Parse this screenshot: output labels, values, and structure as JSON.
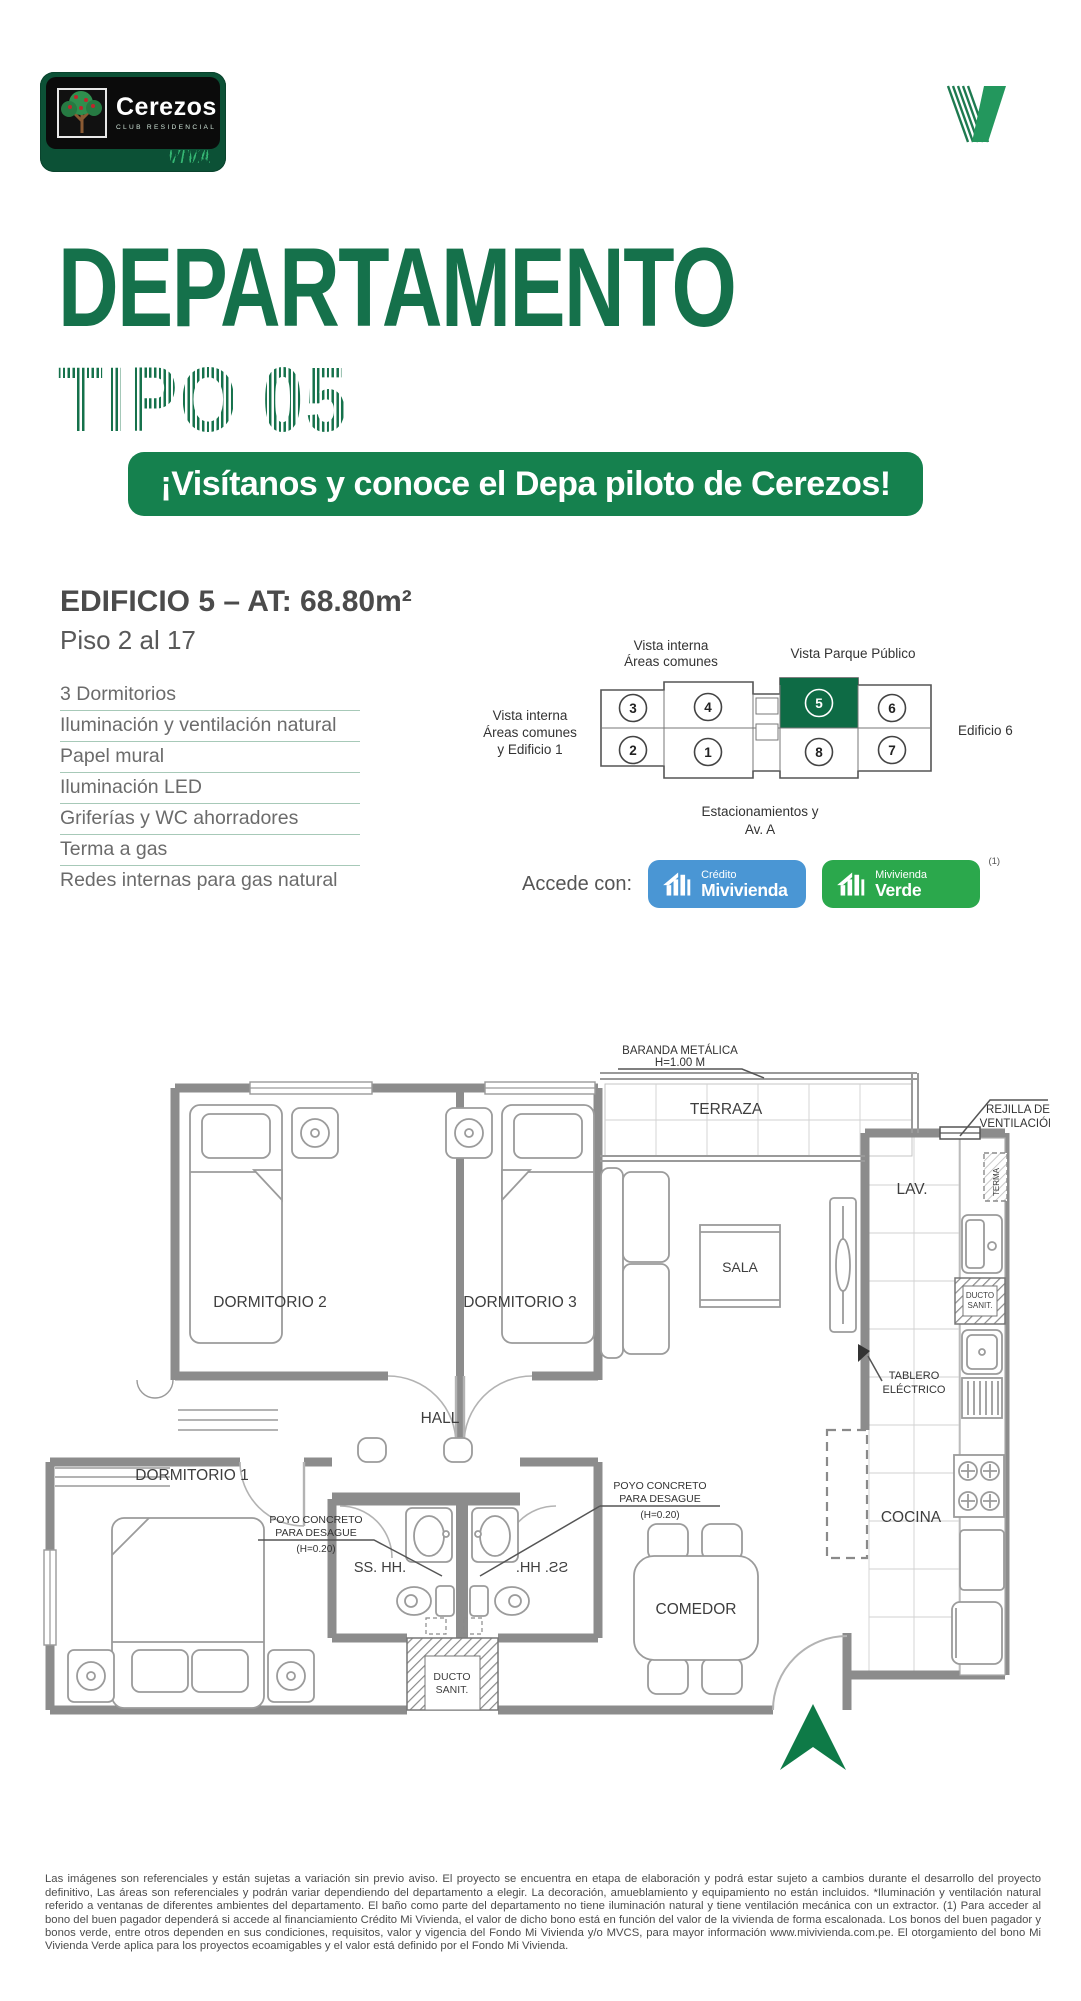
{
  "brand": {
    "name": "Cerezos",
    "tagline": "CLUB RESIDENCIAL",
    "viva": "VIVA"
  },
  "title": {
    "line1": "DEPARTAMENTO",
    "line2": "TIPO 05"
  },
  "banner": {
    "text": "¡Visítanos y conoce el Depa piloto de Cerezos!"
  },
  "building": {
    "heading": "EDIFICIO 5 – AT: 68.80m²",
    "floors": "Piso 2 al 17",
    "features": [
      "3 Dormitorios",
      "Iluminación y ventilación natural",
      "Papel mural",
      "Iluminación LED",
      "Griferías y WC ahorradores",
      "Terma a gas",
      "Redes internas para gas natural"
    ]
  },
  "keyplan": {
    "label_top_left_1": "Vista interna",
    "label_top_left_2": "Áreas comunes",
    "label_top_right": "Vista Parque Público",
    "label_left_1": "Vista interna",
    "label_left_2": "Áreas comunes",
    "label_left_3": "y Edificio 1",
    "label_right": "Edificio 6",
    "label_bottom_1": "Estacionamientos y",
    "label_bottom_2": "Av. A",
    "units": {
      "u1": "1",
      "u2": "2",
      "u3": "3",
      "u4": "4",
      "u5": "5",
      "u6": "6",
      "u7": "7",
      "u8": "8"
    },
    "highlight_color": "#0E6B45"
  },
  "access": {
    "label": "Accede con:",
    "badge_blue_line1": "Crédito",
    "badge_blue_line2": "Mivivienda",
    "badge_green_line1": "Mivivienda",
    "badge_green_line2": "Verde",
    "superscript": "(1)"
  },
  "plan": {
    "dorm1": "DORMITORIO 1",
    "dorm2": "DORMITORIO 2",
    "dorm3": "DORMITORIO 3",
    "hall": "HALL",
    "terraza": "TERRAZA",
    "sala": "SALA",
    "comedor": "COMEDOR",
    "cocina": "COCINA",
    "lav": "LAV.",
    "bath": "SS. HH.",
    "duct1": "DUCTO",
    "duct2": "SANIT.",
    "terma": "TERMA",
    "baranda1": "BARANDA METÁLICA",
    "baranda2": "H=1.00 M",
    "rejilla1": "REJILLA DE",
    "rejilla2": "VENTILACIÓN",
    "tablero1": "TABLERO",
    "tablero2": "ELÉCTRICO",
    "poyo1": "POYO CONCRETO",
    "poyo2": "PARA DESAGUE",
    "poyo3": "(H=0.20)"
  },
  "legal": {
    "text": "Las imágenes son referenciales y están sujetas a variación sin previo aviso. El proyecto se encuentra en etapa de elaboración y podrá estar sujeto a cambios durante el desarrollo del proyecto definitivo, Las áreas son referenciales y podrán variar dependiendo del departamento a elegir. La decoración, amueblamiento y equipamiento no están incluidos. *Iluminación y ventilación natural referido a ventanas de diferentes ambientes del departamento. El baño como parte del departamento no tiene iluminación natural y tiene ventilación mecánica con un extractor. (1) Para acceder al bono del buen pagador dependerá si accede al financiamiento Crédito Mi Vivienda, el valor de dicho bono está en función del valor de la vivienda de forma escalonada. Los bonos del buen pagador y bonos verde, entre otros dependen en sus condiciones, requisitos, valor y vigencia del Fondo Mi Vivienda y/o MVCS, para mayor información www.mivivienda.com.pe. El otorgamiento del bono Mi Vivienda Verde aplica para los proyectos ecoamigables y el valor está definido por el Fondo Mi Vivienda."
  }
}
